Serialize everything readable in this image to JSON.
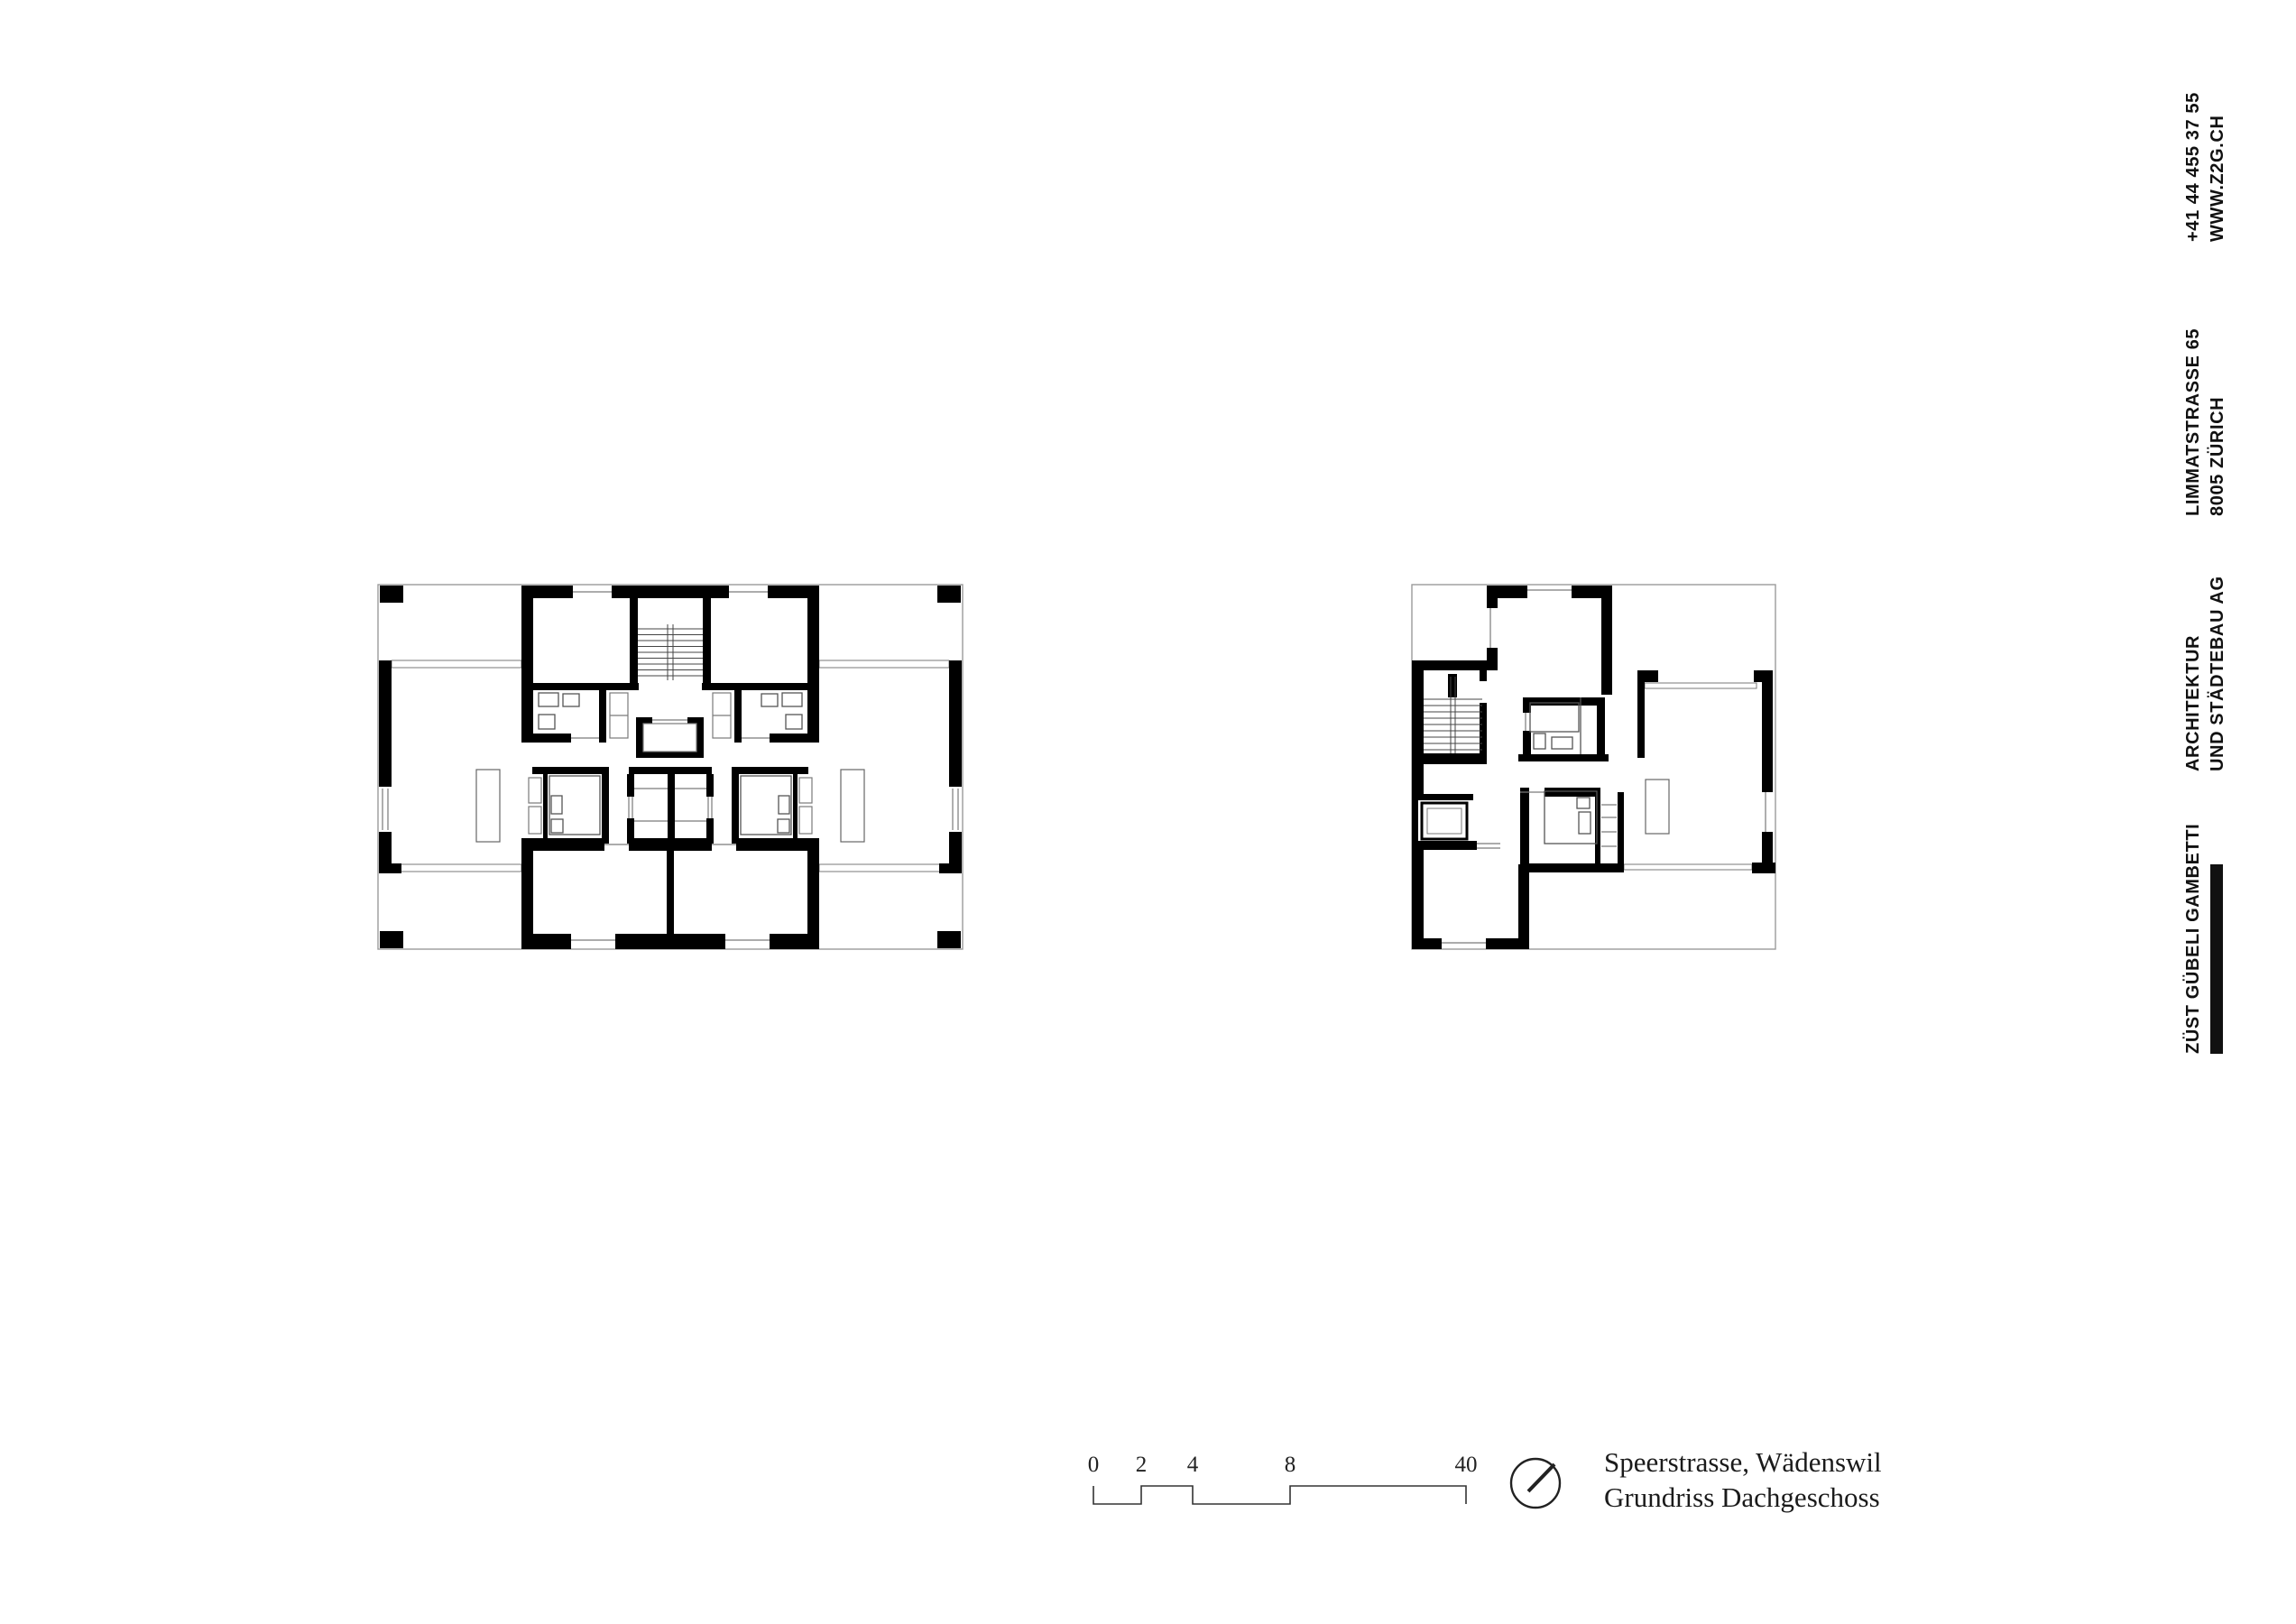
{
  "sheet": {
    "contact": {
      "line1": "+41 44 455 37 55",
      "line2": "WWW.Z2G.CH"
    },
    "address": {
      "line1": "LIMMATSTRASSE 65",
      "line2": "8005 ZÜRICH"
    },
    "firm": {
      "line1": "ARCHITEKTUR",
      "line2": "UND STÄDTEBAU AG"
    },
    "brand": {
      "name": "ZÜST GÜBELI GAMBETTI"
    }
  },
  "titleblock": {
    "line1": "Speerstrasse, Wädenswil",
    "line2": "Grundriss Dachgeschoss"
  },
  "scale_bar": {
    "labels": [
      "0",
      "2",
      "4",
      "8",
      "40"
    ]
  },
  "colors": {
    "ink": "#111111",
    "wall": "#000000",
    "thin_line": "#7a7a7a",
    "outer_line": "#9b9b9b"
  }
}
